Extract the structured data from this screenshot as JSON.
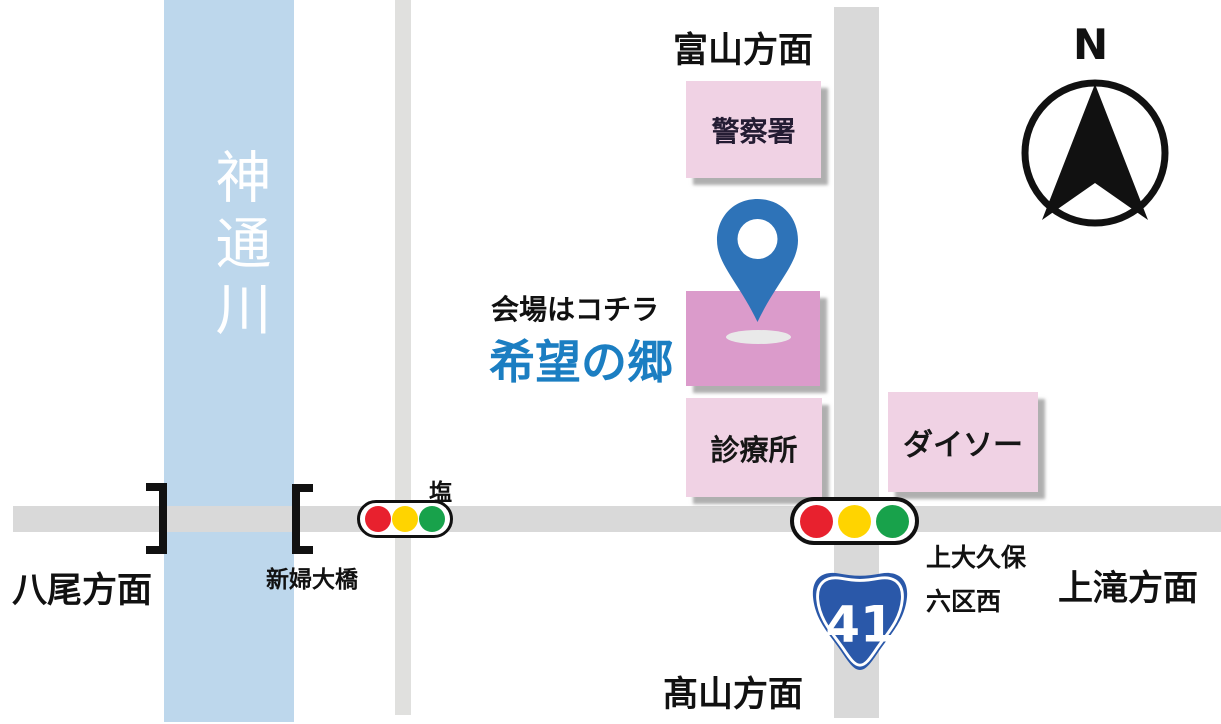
{
  "colors": {
    "river": "#BDD7EC",
    "river-text": "#FFFFFF",
    "road": "#D9D9D9",
    "road-light": "#E0E0DE",
    "building": "#F0D2E4",
    "police-text": "#241C33",
    "venue-box": "#DB9BCB",
    "venue-text": "#1B7EC2",
    "pin": "#2E73B8",
    "pin-shadow": "#E9E9E9",
    "route-badge": "#2A58A9",
    "signal-red": "#E8212E",
    "signal-yellow": "#FFD400",
    "signal-green": "#18A24B",
    "ink": "#111111"
  },
  "map": {
    "river_name": "神通川",
    "directions": {
      "top": "富山方面",
      "left": "八尾方面",
      "right": "上滝方面",
      "bottom": "髙山方面"
    },
    "places": {
      "police": "警察署",
      "clinic": "診療所",
      "daiso": "ダイソー"
    },
    "venue": {
      "caption": "会場はコチラ",
      "name": "希望の郷"
    },
    "bridge_name": "新婦大橋",
    "signal_name": "塩",
    "intersection": {
      "line1": "上大久保",
      "line2": "六区西"
    },
    "route_number": "41",
    "compass_label": "N"
  }
}
